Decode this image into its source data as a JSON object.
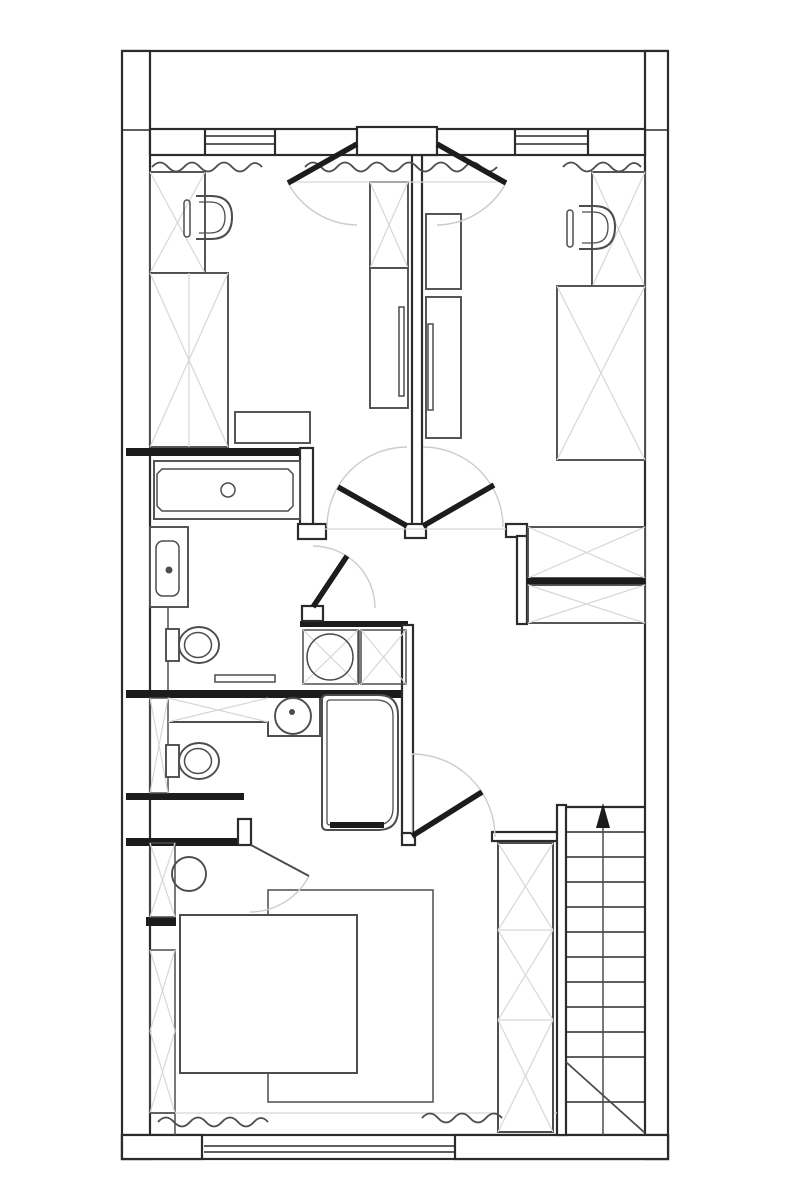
{
  "canvas": {
    "width": 800,
    "height": 1200,
    "background": "#ffffff"
  },
  "palette": {
    "ink": "#2b2b2b",
    "solid": "#1c1c1c",
    "furniture": "#4d4d4d",
    "light": "#d7d7d7",
    "arc": "#cccccc",
    "paper": "#ffffff"
  },
  "drawing": {
    "kind": "architectural floor plan, upper storey, black line work on white",
    "exterior": [
      "top balcony rail",
      "cavity side walls",
      "bottom wall with wide triple-line window"
    ],
    "windows": [
      "top-left double-line window",
      "top-right double-line window",
      "bottom sliding window"
    ],
    "doors": [
      "balcony double entry door with two swing leaves",
      "corridor junction left leaf",
      "corridor junction right leaf",
      "upper bathroom door",
      "lower bedroom door",
      "ensuite thin door"
    ],
    "rooms": {
      "room_top_left": [
        "wardrobe",
        "desk-chair",
        "tall-desk-unit",
        "side-table",
        "closet-wardrobe",
        "closet-cabinet-with-handle"
      ],
      "room_top_right": [
        "closet-cabinet-small",
        "closet-cabinet-with-handle",
        "desk-unit",
        "desk-chair",
        "single-bed",
        "shelf-unit-upper",
        "shelf-unit-lower"
      ],
      "bathroom_upper": [
        "bathtub-with-drain",
        "washbasin",
        "toilet",
        "bath-mat"
      ],
      "laundry_niche": [
        "washing-machine",
        "appliance-cabinet"
      ],
      "bathroom_lower": [
        "shelf-strip",
        "vanity-counter",
        "round-sink-with-tap",
        "toilet",
        "corner-shower-with-threshold"
      ],
      "bedroom": [
        "round-nightstand",
        "double-bed",
        "area-rug",
        "shelf-strips",
        "wardrobe-column",
        "curtain-squiggles"
      ],
      "stairwell": [
        "straight-stair-flight",
        "center-walk-line",
        "up-arrow",
        "cut-diagonal"
      ]
    },
    "curtain_marks": 5,
    "stair_treads": 11
  }
}
